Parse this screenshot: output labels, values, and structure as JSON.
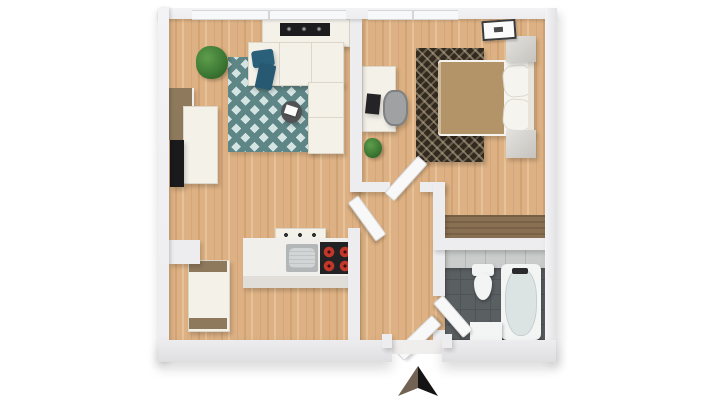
{
  "scene": {
    "type": "3d-floor-plan-top-down",
    "background": "#ffffff"
  },
  "palette": {
    "wall": "#ededef",
    "wall_edge": "#d6d6d9",
    "wall_face": "#e2e2e5",
    "wood": "#ddb183",
    "wood_grain": "#cb9e6d",
    "rug_teal": "#5f8687",
    "rug_teal_light": "#d4e4e2",
    "rug_dark": "#32291f",
    "rug_dark_fleck": "#bfae93",
    "sofa": "#f4f1e9",
    "sofa_seam": "#dcd7c9",
    "pillow_teal": "#2b607a",
    "throw_teal": "#275a72",
    "bed_duvet": "#b29468",
    "linen": "#f6f4ef",
    "headboard": "#e8e4dc",
    "nightstand_light": "#e4e2de",
    "nightstand_dark": "#c6c3be",
    "wardrobe": "#8a7052",
    "wardrobe_dark": "#756046",
    "unit_brown": "#8f795d",
    "counter": "#f1efec",
    "counter_face": "#e1ded9",
    "sink": "#b4b7b8",
    "sink_basin": "#d2d5d5",
    "cooktop": "#222224",
    "burner_red": "#c1382b",
    "burner_core": "#3a0f0c",
    "tile_light": "#c9cccb",
    "tile_dark": "#5a5f62",
    "tile_line": "#4f5457",
    "fixture": "#f3f5f5",
    "tub_inner": "#dce3e3",
    "plant": "#3e7a35",
    "plant_dark": "#2a5a24",
    "tv": "#1a1a1c",
    "table_dark": "#525254",
    "tray_white": "#fafafa",
    "door": "#f8f8f8",
    "door_edge": "#d8d8db",
    "laptop": "#242426",
    "chair_gray": "#9fa1a2",
    "chair_dark": "#7e8081",
    "runner_black": "#1c1c1e",
    "runner_fleck": "#9a9a9a",
    "arrow_light": "#716253",
    "arrow_dark": "#141414",
    "threshold": "#efeeec"
  },
  "rooms": [
    {
      "name": "living-room",
      "floor": "wood",
      "furniture": [
        "sideboard",
        "decor-runner",
        "sectional-sofa",
        "teal-pillow",
        "teal-throw",
        "area-rug-teal",
        "side-table",
        "corner-plant",
        "media-cabinet",
        "media-bench",
        "tv"
      ]
    },
    {
      "name": "bedroom",
      "floor": "wood",
      "furniture": [
        "double-bed",
        "duvet",
        "pillows",
        "headboard",
        "nightstand-upper",
        "nightstand-lower",
        "area-rug-dark",
        "desk",
        "laptop",
        "desk-chair",
        "floor-plant",
        "wardrobe"
      ]
    },
    {
      "name": "kitchen",
      "floor": "wood",
      "furniture": [
        "tall-cabinet",
        "counter",
        "sink",
        "cooktop",
        "wall-shelf"
      ]
    },
    {
      "name": "hallway",
      "floor": "wood",
      "furniture": []
    },
    {
      "name": "bathroom",
      "floor": "tile",
      "furniture": [
        "toilet",
        "bathtub",
        "sink-vanity"
      ]
    }
  ],
  "doors": [
    "entry-door",
    "living-room-door",
    "bedroom-door",
    "bathroom-door"
  ],
  "windows": [
    "living-room-window",
    "bedroom-window",
    "ceiling-frame"
  ],
  "compass": {
    "name": "north-arrow",
    "direction": "up"
  }
}
